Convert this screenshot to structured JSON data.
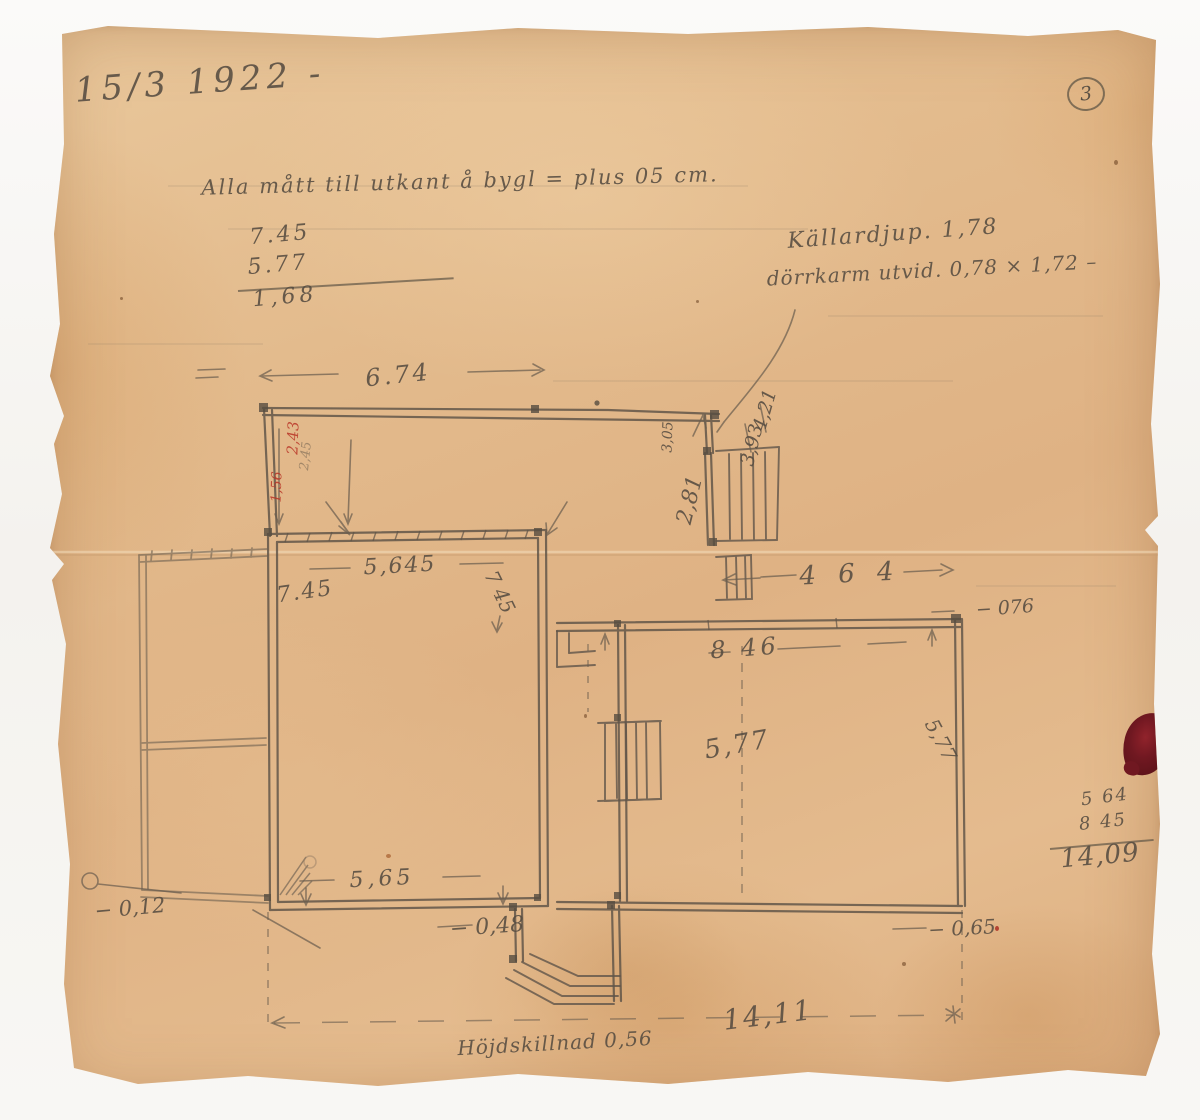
{
  "header": {
    "date": "15/3 1922 -",
    "page_number": "3"
  },
  "notes": {
    "measure_note": "Alla mått till utkant å bygl = plus 05 cm.",
    "cellar_depth": "Källardjup. 1,78",
    "door_frame": "dörrkarm utvid. 0,78 × 1,72 –",
    "height_difference": "Höjdskillnad 0,56"
  },
  "calculations": {
    "top": {
      "minuend": "7.45",
      "subtrahend": "5.77",
      "result": "1,68"
    },
    "right": {
      "addend1": "5 64",
      "addend2": "8 45",
      "sum": "14,09"
    }
  },
  "dimensions": {
    "top_width": "6.74",
    "left_room_width": "5,645",
    "left_room_height_west": "7.45",
    "left_room_height_east": "7 45",
    "east_offset_width": "4 6 4",
    "right_room_width": "8 46",
    "right_room_depth_mid": "5,77",
    "right_room_depth_east": "5,77",
    "left_room_bottom_width": "5,65",
    "total_width": "14,11",
    "offset_west": "− 0,12",
    "offset_south": "− 0,48",
    "offset_southeast": "− 0,65",
    "offset_northeast": "− 076",
    "stair_run_a": "3,05",
    "stair_run_b": "2,81",
    "stair_run_c": "3,93",
    "stair_run_d": "4,21"
  },
  "red_marks": {
    "upper": "2,43",
    "lower": "1,56"
  },
  "pencil_marks": {
    "wall_inner": "2,45"
  },
  "colors": {
    "paper": "#e2b88a",
    "pencil": "#675b4d",
    "red_pencil": "#b93527",
    "ink_stain": "#70121f"
  }
}
